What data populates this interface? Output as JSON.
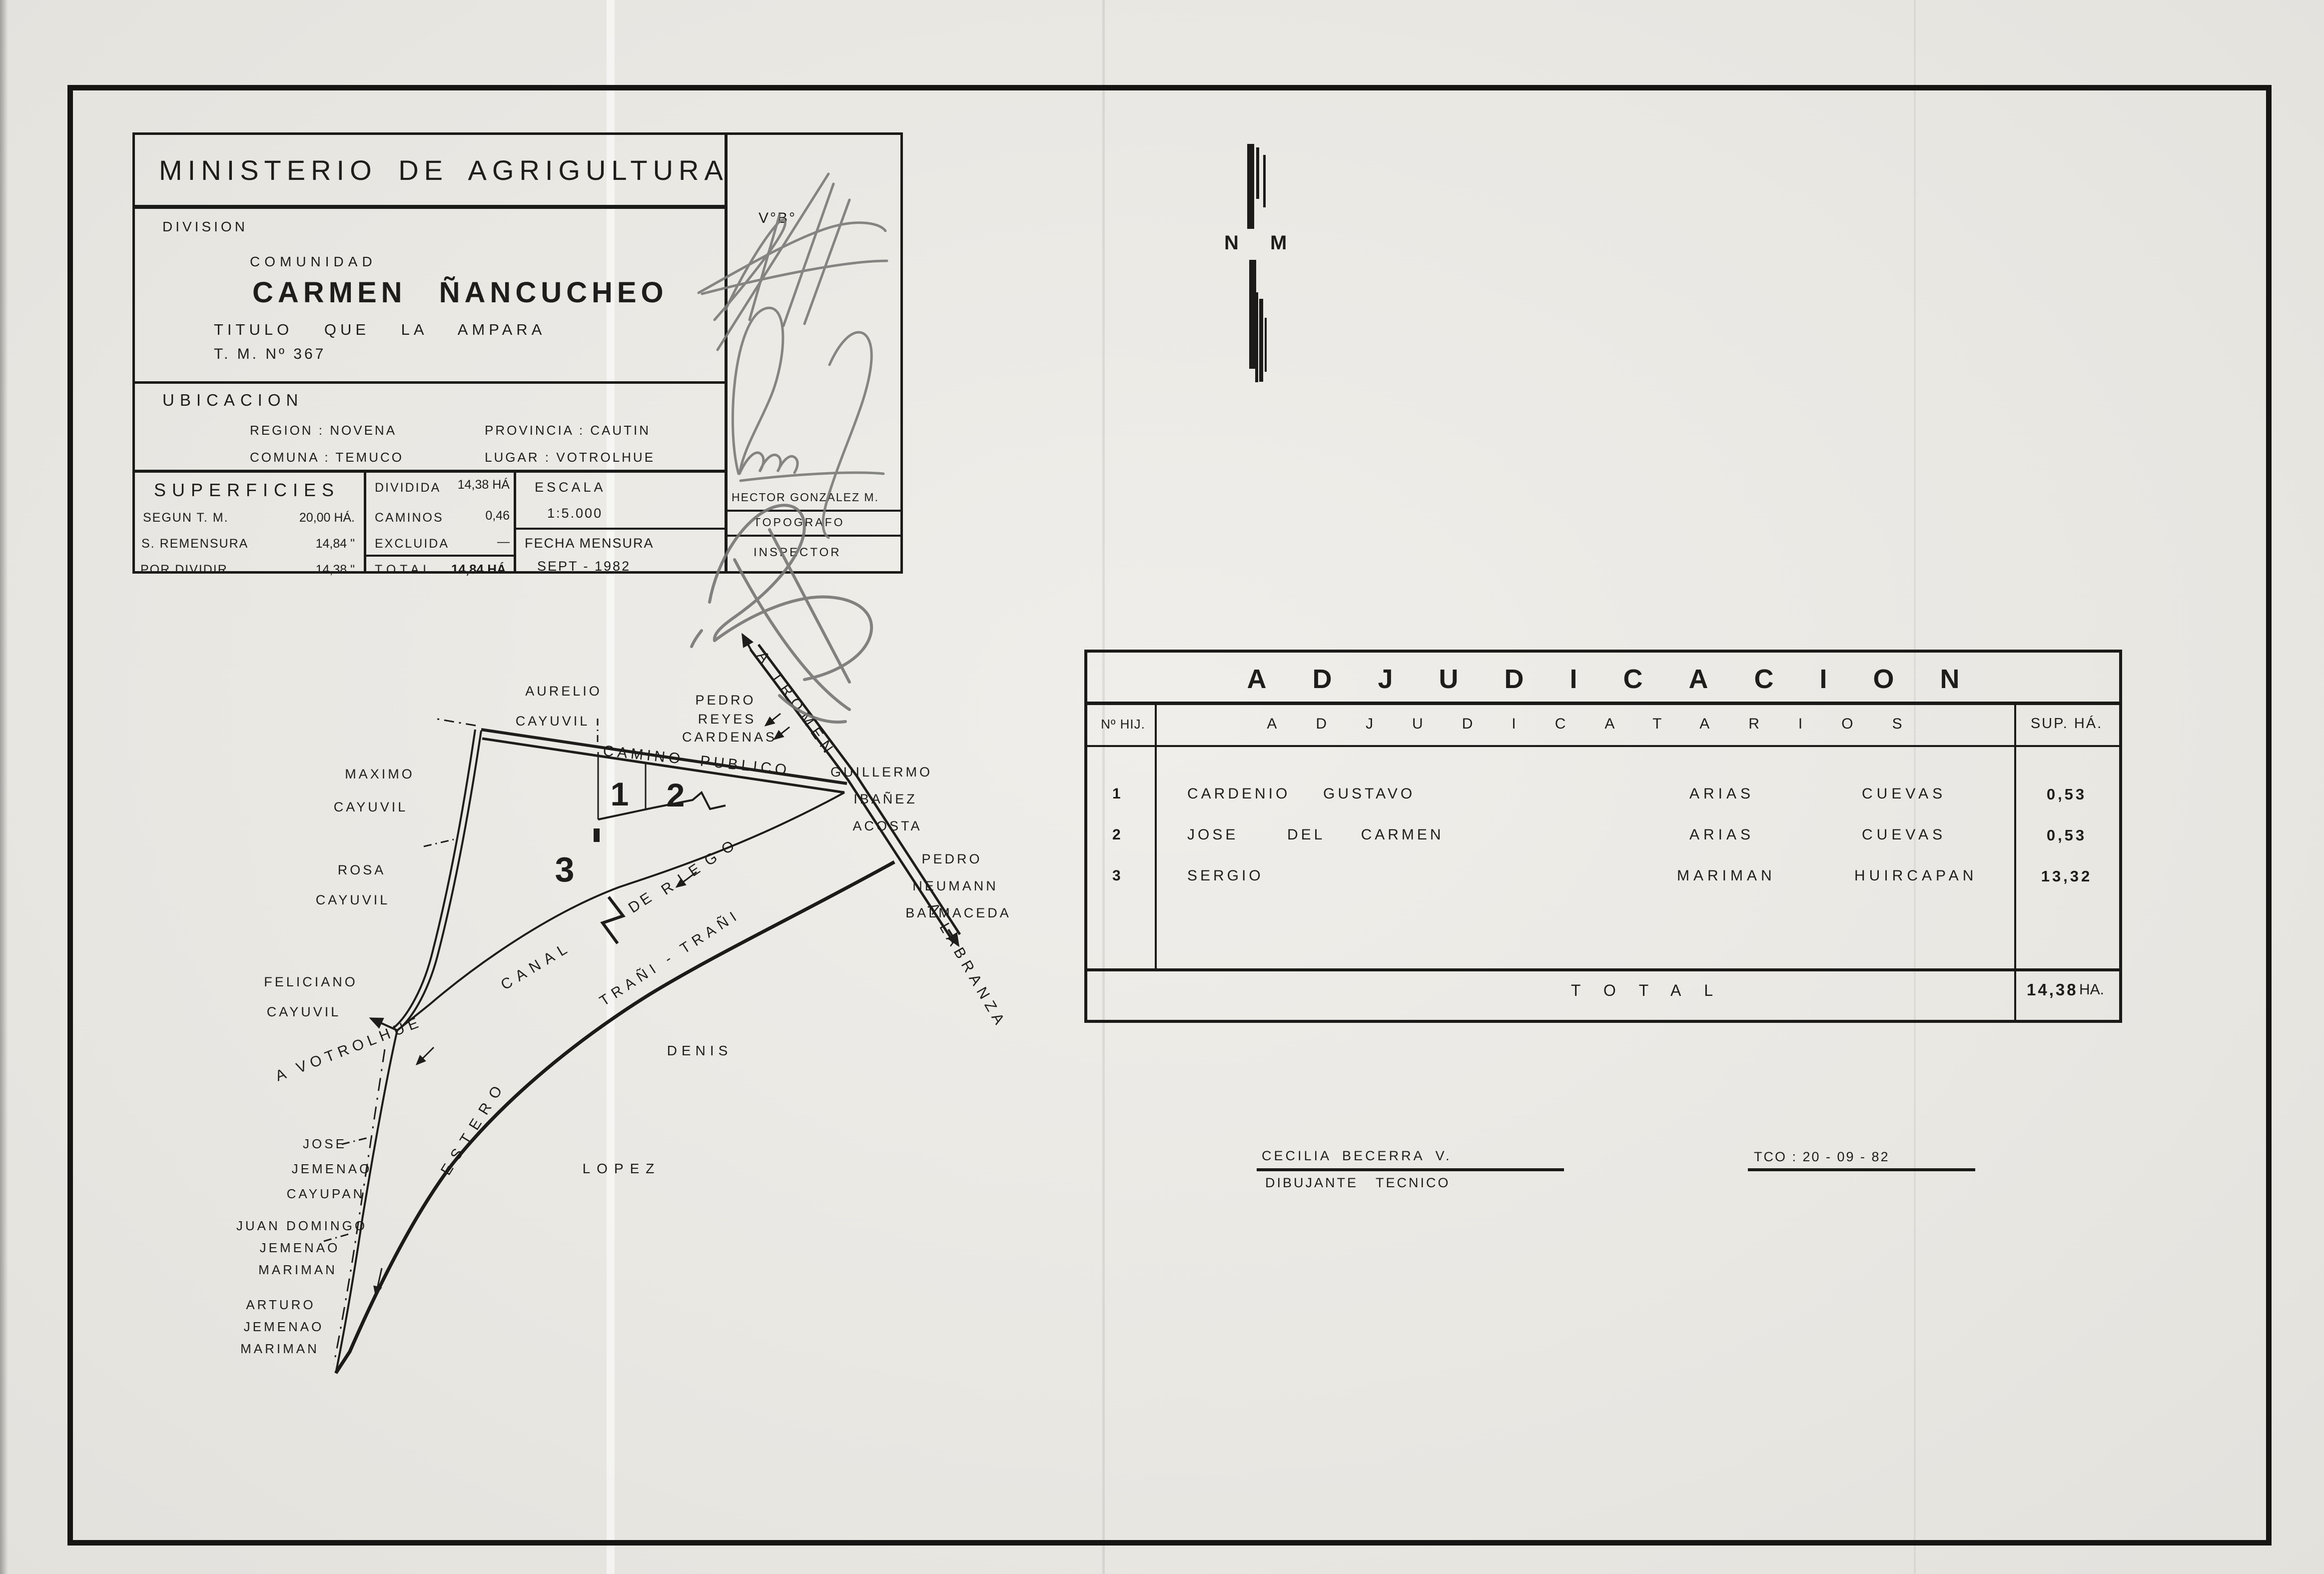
{
  "title_block": {
    "ministry": "MINISTERIO DE AGRIGULTURA",
    "division_label": "DIVISION",
    "comunidad_label": "COMUNIDAD",
    "community_name": "CARMEN ÑANCUCHEO",
    "titulo_line": "TITULO QUE LA AMPARA",
    "tm_line": "T. M. Nº 367",
    "ubicacion_label": "UBICACION",
    "ubicacion_region": "REGION : NOVENA",
    "ubicacion_provincia": "PROVINCIA : CAUTIN",
    "ubicacion_comuna": "COMUNA : TEMUCO",
    "ubicacion_lugar": "LUGAR : VOTROLHUE",
    "superficies_label": "SUPERFICIES",
    "sup_rows": [
      {
        "label": "SEGUN  T. M.",
        "value": "20,00 HÁ."
      },
      {
        "label": "S. REMENSURA",
        "value": "14,84 \""
      },
      {
        "label": "POR  DIVIDIR",
        "value": "14,38 \""
      }
    ],
    "div_rows": [
      {
        "label": "DIVIDIDA",
        "value": "14,38 HÁ"
      },
      {
        "label": "CAMINOS",
        "value": "0,46"
      },
      {
        "label": "EXCLUIDA",
        "value": "—"
      }
    ],
    "total_label": "TOTAL",
    "total_value": "14,84 HÁ.",
    "escala_label": "ESCALA",
    "escala_value": "1:5.000",
    "fecha_label": "FECHA MENSURA",
    "fecha_value": "SEPT - 1982",
    "vobo": "V°B°",
    "surveyor_name": "HECTOR GONZALEZ M.",
    "surveyor_role": "TOPOGRAFO",
    "inspector_role": "INSPECTOR"
  },
  "north_arrow": {
    "label": "N M"
  },
  "map": {
    "parcel_1": "1",
    "parcel_2": "2",
    "parcel_3": "3",
    "camino_publico": "CAMINO PUBLICO",
    "a_tromen": "A TROMEN",
    "a_labranza": "A LABRANZA",
    "a_votrolhue": "A VOTROLHUE",
    "canal_word1": "CANAL",
    "canal_word2": "DE",
    "canal_word3": "RIEGO",
    "trani_label": "TRAÑI - TRAÑI",
    "estero_label": "ESTERO",
    "denis": "DENIS",
    "lopez": "LOPEZ",
    "aurelio": [
      "AURELIO",
      "CAYUVIL"
    ],
    "pedro_reyes": [
      "PEDRO",
      "REYES",
      "CARDENAS"
    ],
    "guillermo": [
      "GUILLERMO",
      "IBAÑEZ",
      "ACOSTA"
    ],
    "maximo": [
      "MAXIMO",
      "CAYUVIL"
    ],
    "rosa": [
      "ROSA",
      "CAYUVIL"
    ],
    "pedro_neumann": [
      "PEDRO",
      "NEUMANN",
      "BALMACEDA"
    ],
    "feliciano": [
      "FELICIANO",
      "CAYUVIL"
    ],
    "jose": [
      "JOSE",
      "JEMENAO",
      "CAYUPAN"
    ],
    "juan": [
      "JUAN DOMINGO",
      "JEMENAO",
      "MARIMAN"
    ],
    "arturo": [
      "ARTURO",
      "JEMENAO",
      "MARIMAN"
    ]
  },
  "adjudicacion": {
    "title": "ADJUDICACION",
    "col_hij": "Nº HIJ.",
    "col_names": "ADJUDICATARIOS",
    "col_sup": "SUP. HÁ.",
    "rows": [
      {
        "n": "1",
        "given": "CARDENIO",
        "given2": "GUSTAVO",
        "surname": "ARIAS",
        "surname2": "CUEVAS",
        "sup": "0,53"
      },
      {
        "n": "2",
        "given": "JOSE",
        "given2": "DEL CARMEN",
        "surname": "ARIAS",
        "surname2": "CUEVAS",
        "sup": "0,53"
      },
      {
        "n": "3",
        "given": "SERGIO",
        "given2": "",
        "surname": "MARIMAN",
        "surname2": "HUIRCAPAN",
        "sup": "13,32"
      }
    ],
    "total_label": "TOTAL",
    "total_value": "14,38",
    "total_unit": "HA."
  },
  "footer": {
    "author": "CECILIA BECERRA V.",
    "author_role": "DIBUJANTE TECNICO",
    "ref": "TCO : 20 - 09 - 82"
  },
  "colors": {
    "paper": "#e9e7e2",
    "ink": "#1e1d1b",
    "pencil": "#7a7a78"
  }
}
